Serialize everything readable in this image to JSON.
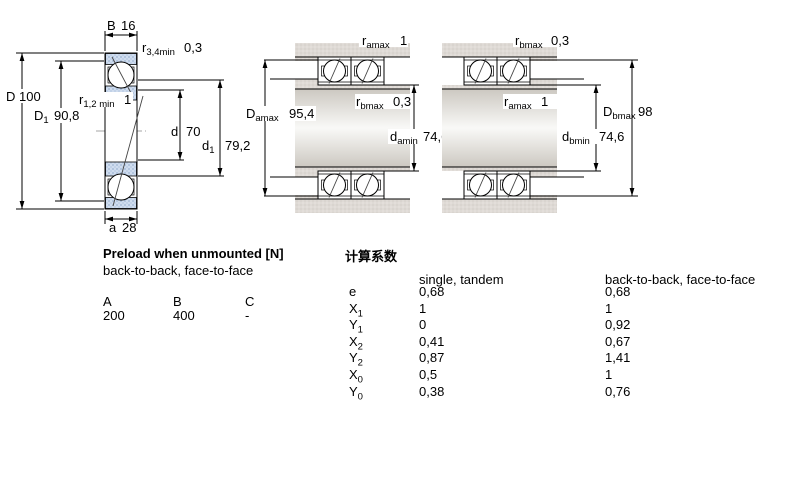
{
  "dims": {
    "left_B": {
      "sym": "B",
      "sub": "",
      "val": "16"
    },
    "left_r34": {
      "sym": "r",
      "sub": "3,4min",
      "val": "0,3"
    },
    "left_D": {
      "sym": "D",
      "sub": "",
      "val": "100"
    },
    "left_D1": {
      "sym": "D",
      "sub": "1",
      "val": "90,8"
    },
    "left_r12": {
      "sym": "r",
      "sub": "1,2 min",
      "val": "1"
    },
    "left_d": {
      "sym": "d",
      "sub": "",
      "val": "70"
    },
    "left_d1": {
      "sym": "d",
      "sub": "1",
      "val": "79,2"
    },
    "left_a": {
      "sym": "a",
      "sub": "",
      "val": "28"
    },
    "mid_ramax": {
      "sym": "r",
      "sub": "amax",
      "val": "1"
    },
    "mid_rbmax": {
      "sym": "r",
      "sub": "bmax",
      "val": "0,3"
    },
    "mid_Damax": {
      "sym": "D",
      "sub": "amax",
      "val": "95,4"
    },
    "mid_damin": {
      "sym": "d",
      "sub": "amin",
      "val": "74,6"
    },
    "right_rbmax": {
      "sym": "r",
      "sub": "bmax",
      "val": "0,3"
    },
    "right_ramax": {
      "sym": "r",
      "sub": "amax",
      "val": "1"
    },
    "right_Dbmax": {
      "sym": "D",
      "sub": "bmax",
      "val": "98"
    },
    "right_dbmin": {
      "sym": "d",
      "sub": "bmin",
      "val": "74,6"
    }
  },
  "preload": {
    "title": "Preload when unmounted [N]",
    "subtitle": "back-to-back, face-to-face",
    "columns": [
      "A",
      "B",
      "C"
    ],
    "values": [
      "200",
      "400",
      "-"
    ]
  },
  "factors": {
    "title": "计算系数",
    "col1_header": "single, tandem",
    "col2_header": "back-to-back, face-to-face",
    "rows": [
      {
        "sym": "e",
        "sub": "",
        "v1": "0,68",
        "v2": "0,68"
      },
      {
        "sym": "X",
        "sub": "1",
        "v1": "1",
        "v2": "1"
      },
      {
        "sym": "Y",
        "sub": "1",
        "v1": "0",
        "v2": "0,92"
      },
      {
        "sym": "X",
        "sub": "2",
        "v1": "0,41",
        "v2": "0,67"
      },
      {
        "sym": "Y",
        "sub": "2",
        "v1": "0,87",
        "v2": "1,41"
      },
      {
        "sym": "X",
        "sub": "0",
        "v1": "0,5",
        "v2": "1"
      },
      {
        "sym": "Y",
        "sub": "0",
        "v1": "0,38",
        "v2": "0,76"
      }
    ]
  },
  "colors": {
    "ring_blue": "#cfdcee",
    "housing_gray": "#dedad5",
    "line_black": "#000000"
  }
}
